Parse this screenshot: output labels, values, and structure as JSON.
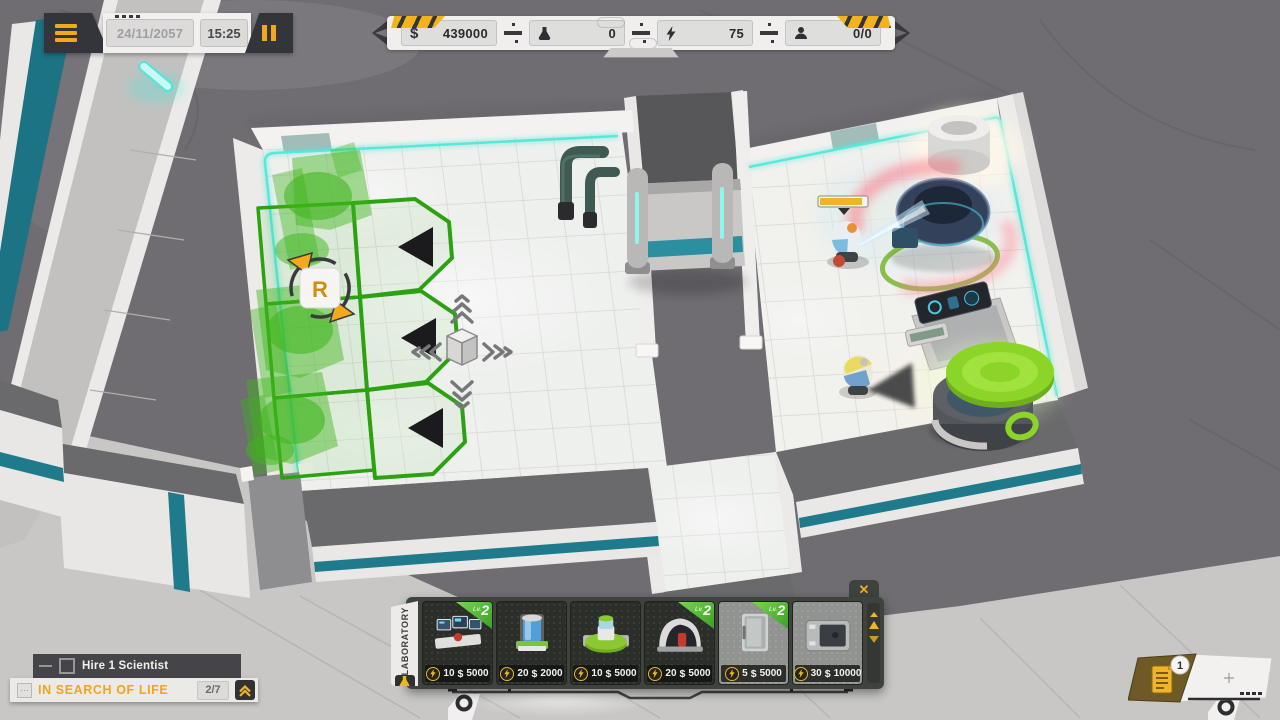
{
  "hud": {
    "clock": {
      "date": "24/11/2057",
      "time": "15:25"
    },
    "resources": {
      "money": "439000",
      "science": "0",
      "energy": "75",
      "staff": "0/0"
    },
    "icons": {
      "dollar": "$"
    }
  },
  "build_menu": {
    "category": "LABORATORY",
    "close_label": "✕",
    "currency": "$",
    "lv_prefix": "Lv.",
    "items": [
      {
        "level": "2",
        "power": "10",
        "price": "5000"
      },
      {
        "power": "20",
        "price": "2000"
      },
      {
        "power": "10",
        "price": "5000"
      },
      {
        "level": "2",
        "power": "20",
        "price": "5000"
      },
      {
        "level": "2",
        "power": "5",
        "price": "5000"
      },
      {
        "power": "30",
        "price": "10000"
      }
    ]
  },
  "quests": {
    "task": "Hire 1 Scientist",
    "mission": "IN SEARCH OF LIFE",
    "mission_icon": "…",
    "progress": "2/7"
  },
  "notifications": {
    "reports_badge": "1"
  },
  "gizmos": {
    "rotate_key": "R"
  },
  "colors": {
    "accent_yellow": "#F2A91C",
    "accent_teal": "#3AE2D6",
    "ghost_green": "#3DB51A",
    "alert_red": "#FF6B7A",
    "panel_dark": "#3F433E"
  }
}
